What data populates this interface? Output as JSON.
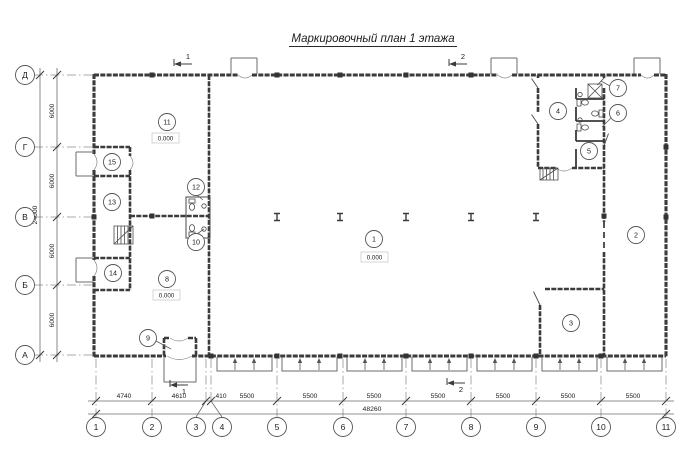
{
  "title": "Маркировочный план 1 этажа",
  "axes": {
    "cols": [
      {
        "label": "1"
      },
      {
        "label": "2"
      },
      {
        "label": "3"
      },
      {
        "label": "4"
      },
      {
        "label": "5"
      },
      {
        "label": "6"
      },
      {
        "label": "7"
      },
      {
        "label": "8"
      },
      {
        "label": "9"
      },
      {
        "label": "10"
      },
      {
        "label": "11"
      }
    ],
    "rows": [
      {
        "label": "Д"
      },
      {
        "label": "Г"
      },
      {
        "label": "В"
      },
      {
        "label": "Б"
      },
      {
        "label": "А"
      }
    ]
  },
  "dims": {
    "bottom_chain": [
      "4740",
      "4610",
      "410",
      "5500",
      "5500",
      "5500",
      "5500",
      "5500",
      "5500",
      "5500"
    ],
    "bottom_total": "48260",
    "left_chain": [
      "6000",
      "6000",
      "6000",
      "6000"
    ],
    "left_total": "24000"
  },
  "rooms": [
    {
      "n": "1",
      "elev": "0.000"
    },
    {
      "n": "2"
    },
    {
      "n": "3"
    },
    {
      "n": "4"
    },
    {
      "n": "5"
    },
    {
      "n": "6"
    },
    {
      "n": "7"
    },
    {
      "n": "8",
      "elev": "0.000"
    },
    {
      "n": "9"
    },
    {
      "n": "10"
    },
    {
      "n": "11",
      "elev": "0.000"
    },
    {
      "n": "12"
    },
    {
      "n": "13"
    },
    {
      "n": "14"
    },
    {
      "n": "15"
    }
  ],
  "sections": [
    "1",
    "2"
  ],
  "colors": {
    "wall": "#3b3b3b",
    "thin": "#5a5a5a",
    "dim": "#6b6b6b",
    "text": "#1c1c1c"
  }
}
